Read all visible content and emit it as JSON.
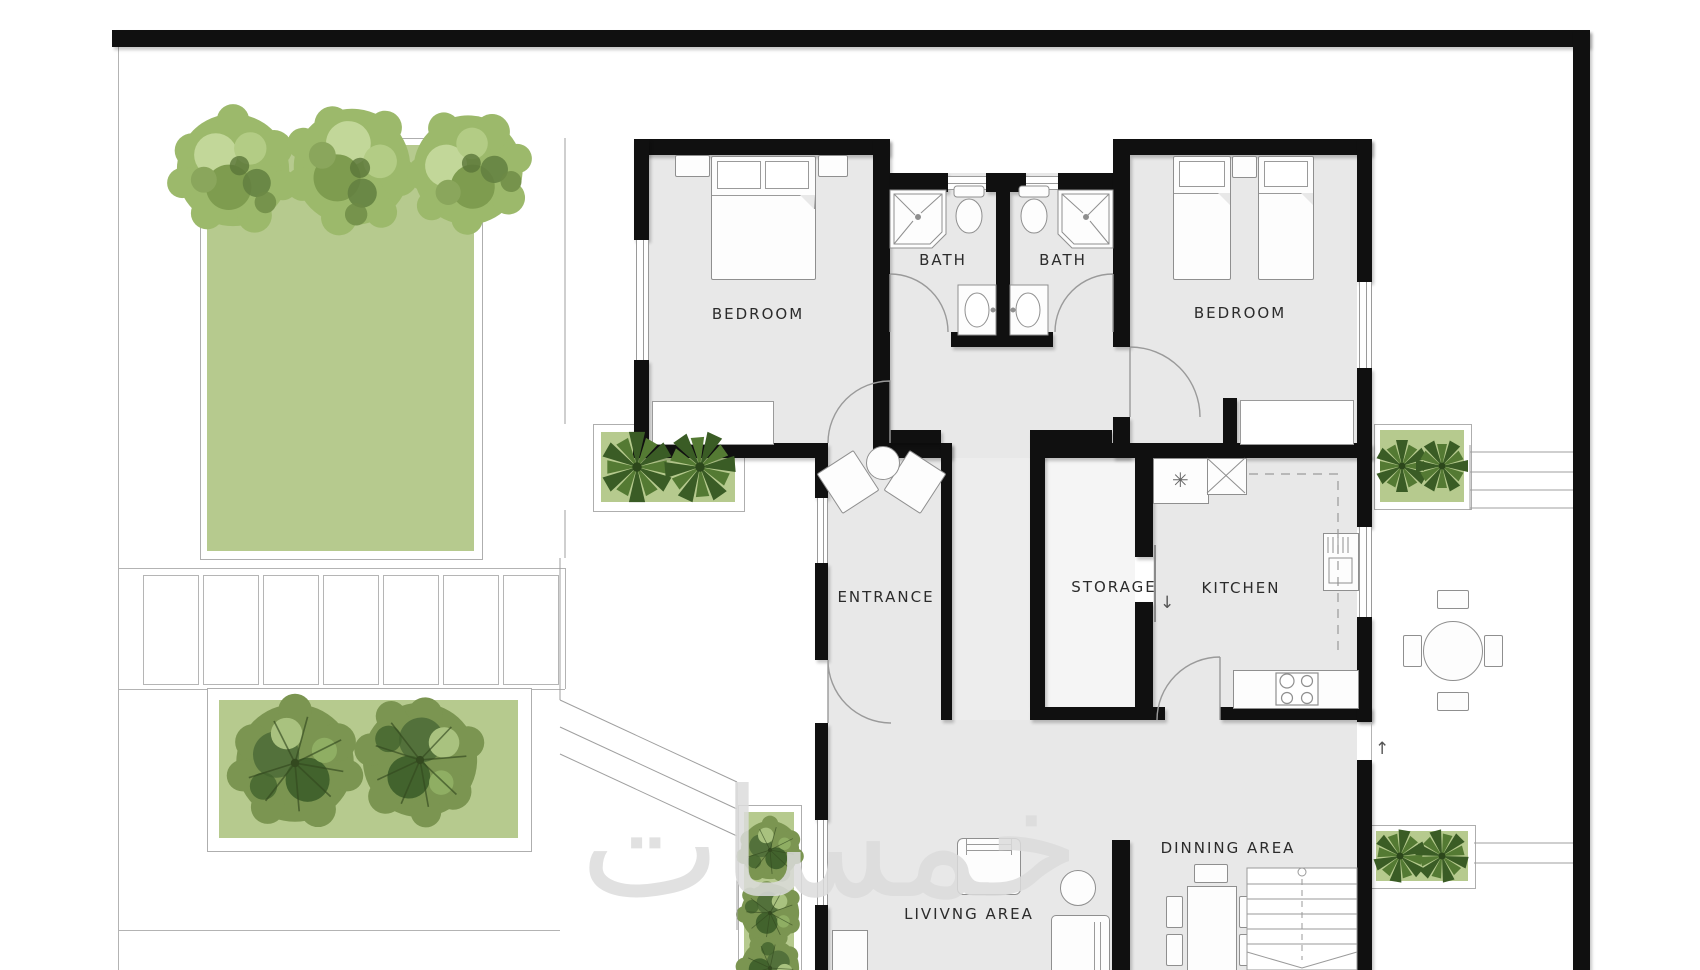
{
  "plan": {
    "type": "residential floor plan with garden",
    "rooms": {
      "bedroom_left": "BEDROOM",
      "bedroom_right": "BEDROOM",
      "bath_left": "BATH",
      "bath_right": "BATH",
      "entrance": "ENTRANCE",
      "storage": "STORAGE",
      "kitchen": "KITCHEN",
      "dining": "DINNING AREA",
      "living": "LIVIVNG AREA"
    },
    "symbols": {
      "kitchen_sink_asterisk": "✳",
      "storage_door_arrow": "↓",
      "patio_step_arrow": "↑"
    },
    "watermark_text": "خمسات",
    "colors": {
      "wall": "#101010",
      "floor": "#e8e8e8",
      "lawn_green": "#b6ca8e",
      "tree_light": "#9cb96b",
      "tree_dark": "#7b9551",
      "agave_dark": "#3a5c25",
      "outline_gray": "#9a9a9a",
      "watermark_gray": "#dcdcdc"
    }
  }
}
